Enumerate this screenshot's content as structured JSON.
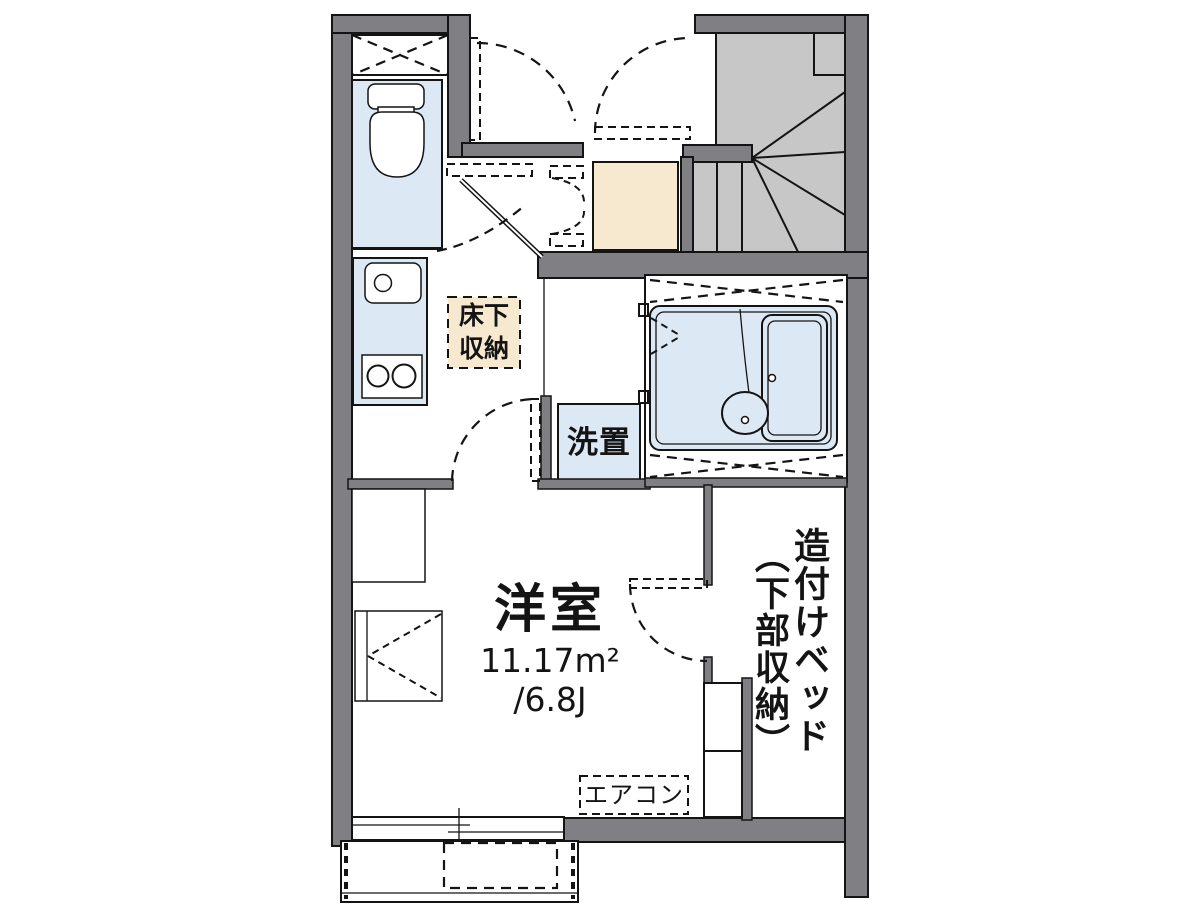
{
  "floor_plan": {
    "labels": {
      "room_name": "洋室",
      "room_area_sqm": "11.17m²",
      "room_area_tatami": "/6.8J",
      "underfloor_storage": "床下\n収納",
      "laundry": "洗置",
      "aircon": "エアコン",
      "built_in_bed_primary": "造付けベッド",
      "built_in_bed_secondary": "（下部収納）"
    },
    "colors": {
      "wall": "#808084",
      "stair": "#c6c7c6",
      "fixture": "#dde8f5",
      "beige": "#f6e9cf",
      "line": "#141414",
      "bg": "#ffffff"
    }
  }
}
